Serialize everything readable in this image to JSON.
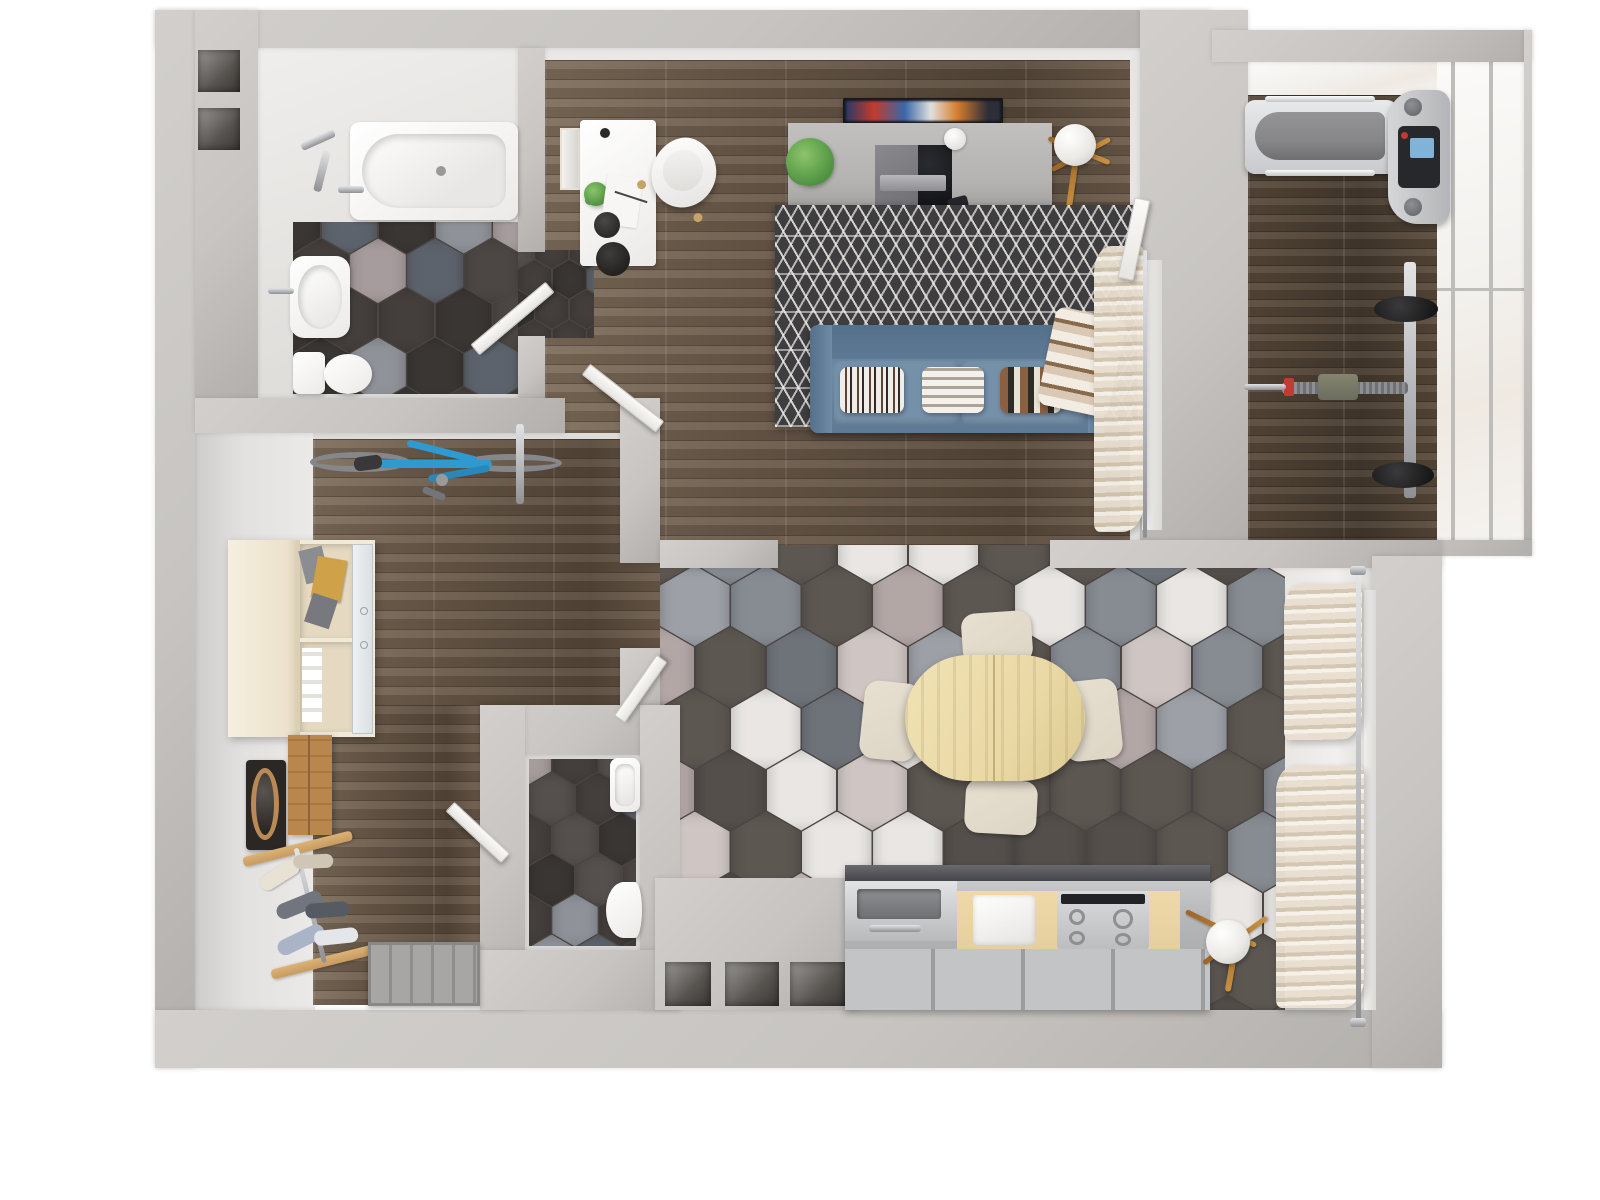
{
  "scene": {
    "kind": "3d-rendered-floor-plan",
    "view": "top-down",
    "subject": "one-bedroom apartment with living room, bathroom, wc, hallway, kitchen-dining area and glazed balcony gym",
    "visible_text": ""
  },
  "palette": {
    "wall": "#c7c4c1",
    "wallTop": "#d2cfcc",
    "wallShade": "#b2afac",
    "woodBase": "#6b5a4a",
    "woodDark": "#564839",
    "woodStreak": "#7e6d5b",
    "woodGymBase": "#5a4b3c",
    "woodGymDark": "#453a2e",
    "rugBase": "#3e3e40",
    "sofa": "#6e8aa4",
    "sofaDark": "#5d7993",
    "sofaSeat": "#7590a9",
    "tableWood": "#ead9a6",
    "chairCream": "#ddd5c4",
    "consoleGray": "#b5b3b1",
    "consoleWood": "#8a6239",
    "plantGreen": "#5c9e4a",
    "plantDark": "#3f7a35",
    "lampWood": "#c9913f",
    "curtain": "#e9dfd0",
    "curtainShadow": "#d3c6b1",
    "closetCream": "#f2ead9",
    "closetInner": "#e5d9c1",
    "cabinetWood": "#b9874d",
    "rackWood": "#c89b5f",
    "bikeBlue": "#2f9ad0",
    "chrome": "#b9babd",
    "chromeDark": "#8f9093",
    "cabinetBeige": "#e6cf9e",
    "counterDark": "#46464a",
    "doorGray": "#9f9d9b",
    "screenBlue": "#7fb3d8",
    "blanketBase": "#d9c9b4",
    "blanketStripe": "#8a6a4e",
    "blanketLight": "#f2ece2",
    "treadBelt": "#87878a"
  },
  "hex": {
    "themes": {
      "dark": [
        "#443f3d",
        "#443f3d",
        "#3a3634",
        "#4c4745",
        "#443f3d",
        "#5d636c",
        "#3a3634",
        "#8f9399",
        "#443f3d",
        "#a79c9d",
        "#e8e5e2",
        "#55504e",
        "#443f3d",
        "#5d636c"
      ],
      "light": [
        "#5d5752",
        "#5d5752",
        "#878c93",
        "#e9e6e3",
        "#5d5752",
        "#b3a7a6",
        "#6e737a",
        "#5d5752",
        "#cfc6c3",
        "#878c93",
        "#544f4b",
        "#e9e6e3",
        "#5d5752",
        "#9da1a7"
      ]
    }
  },
  "rooms": [
    {
      "id": "bathroom",
      "items": [
        "bathtub",
        "shower-mixer",
        "washbasin",
        "toilet",
        "hex-tile-floor",
        "wall-niches"
      ]
    },
    {
      "id": "living-room",
      "items": [
        "white-desk",
        "desk-chair",
        "picture-frame",
        "desk-plant",
        "desk-lamp",
        "tv",
        "media-console",
        "game-console",
        "webcam-ball",
        "potted-plant",
        "floor-lamp",
        "geometric-rug",
        "blue-sofa",
        "patterned-pillows",
        "plaid-blanket",
        "window-curtain",
        "balcony-door"
      ]
    },
    {
      "id": "balcony-gym",
      "items": [
        "treadmill",
        "weight-rack",
        "weight-plates",
        "barbell",
        "glass-wall",
        "wood-floor"
      ]
    },
    {
      "id": "hallway",
      "items": [
        "bicycle",
        "wardrobe",
        "wall-mirror",
        "wood-cabinet",
        "shoe-rack",
        "entrance-door"
      ]
    },
    {
      "id": "wc",
      "items": [
        "washbasin",
        "toilet",
        "hex-tile-floor"
      ]
    },
    {
      "id": "kitchen-dining",
      "items": [
        "oval-dining-table",
        "dining-chairs-x4",
        "kitchen-counter",
        "stainless-sink",
        "gas-cooktop",
        "appliance-front",
        "floor-lamp",
        "window-curtains",
        "wall-niches-x3",
        "hex-tile-floor"
      ]
    }
  ]
}
